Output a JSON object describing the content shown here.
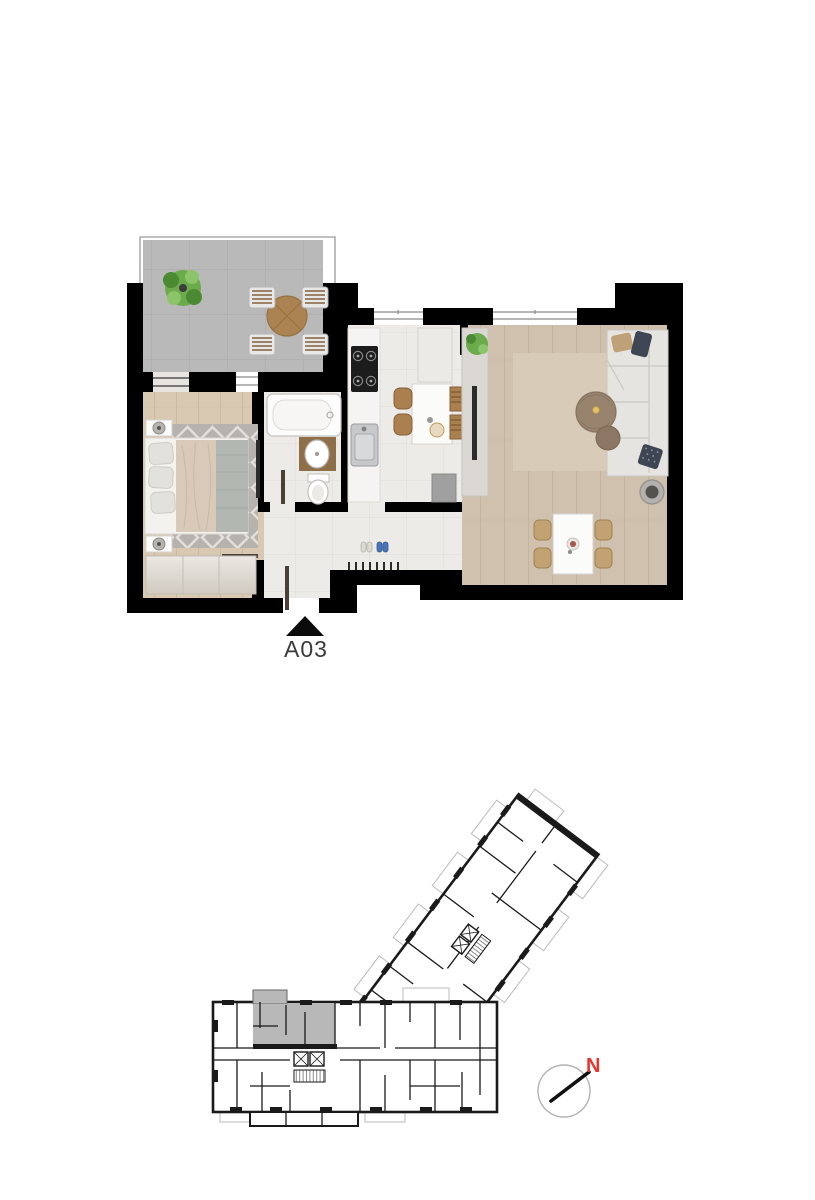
{
  "page": {
    "background": "#ffffff"
  },
  "unit_plan": {
    "label": "A03",
    "entrance_marker": "entrance-arrow-icon"
  },
  "key_plan": {
    "compass": {
      "label": "N"
    },
    "highlight_present": true
  },
  "icons": {
    "entrance": "entrance-arrow-icon",
    "compass": "compass-icon",
    "elevator": "elevator-icon",
    "stairs": "stairs-icon",
    "plant": "plant-icon"
  },
  "colors": {
    "pageBg": "#ffffff",
    "wall": "#000000",
    "kpWall": "#1a1a1a",
    "terrace": "#b9b9b9",
    "terraceLine": "#a9a9a9",
    "woodA": "#d9c9b3",
    "woodALine": "#ccb9a1",
    "woodB": "#cfc1ae",
    "woodBLine": "#c3b4a0",
    "tile": "#edebe7",
    "tileLine": "#e0ddd8",
    "rug": "#b6b3ae",
    "rugPattern": "#e3e0dc",
    "livingRug": "#d8ccb9",
    "white": "#fbfbfa",
    "furnBorder": "#d6d3ce",
    "sofa": "#e6e4e0",
    "sofaLine": "#cbc8c3",
    "woodFurn": "#a9804e",
    "woodSlat": "#86613a",
    "counterWood": "#8f6f4a",
    "plant": "#6cab4c",
    "plantDark": "#4b8a33",
    "dark": "#2b2b2b",
    "steel": "#c6c8ca",
    "steelLine": "#9b9da0",
    "navy": "#3e4654",
    "beige": "#bfa077",
    "glassLine": "#8a8a8a",
    "doorLeaf": "#4a4038",
    "highlight": "#b8b8b8",
    "balcony": "#bbbbbb",
    "labelColor": "#3a3a3a",
    "compassRed": "#e8352e",
    "compassRing": "#b3b3b3"
  }
}
